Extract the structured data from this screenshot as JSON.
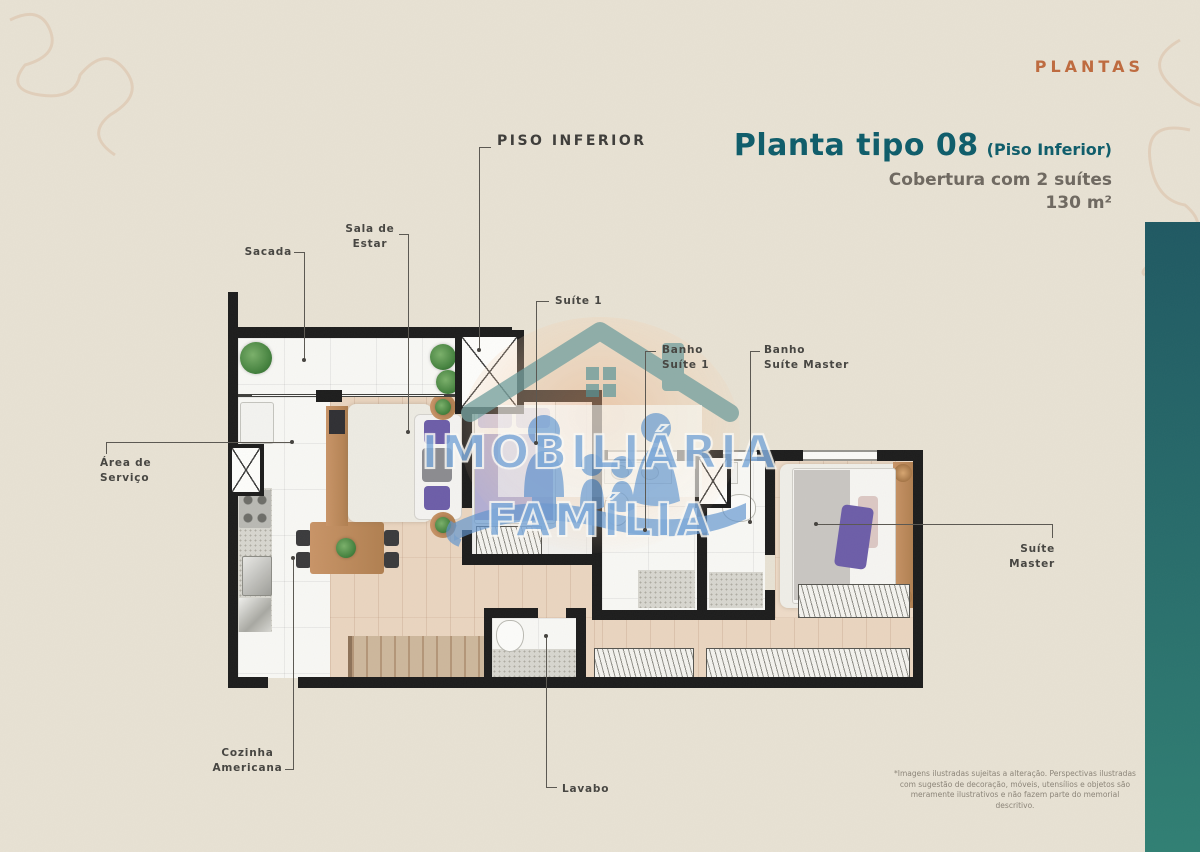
{
  "header": {
    "tag": "PLANTAS",
    "title": "Planta tipo 08",
    "title_note": "(Piso Inferior)",
    "subtitle": "Cobertura com 2 suítes",
    "area": "130 m²"
  },
  "plan": {
    "floor_label": "PISO  INFERIOR",
    "rooms": [
      {
        "label": "Sacada"
      },
      {
        "label": "Sala de\nEstar"
      },
      {
        "label": "Suíte 1"
      },
      {
        "label": "Banho\nSuíte 1"
      },
      {
        "label": "Banho\nSuíte Master"
      },
      {
        "label": "Área de\nServiço"
      },
      {
        "label": "Suíte\nMaster"
      },
      {
        "label": "Cozinha\nAmericana"
      },
      {
        "label": "Lavabo"
      }
    ]
  },
  "watermark": {
    "line1": "IMOBILIÁRIA",
    "line2": "FAMÍLIA"
  },
  "footer": {
    "disclaimer": "*Imagens ilustradas sujeitas a alteração. Perspectivas ilustradas com sugestão de decoração, móveis, utensílios e objetos são meramente ilustrativos e não fazem parte do memorial descritivo."
  },
  "colors": {
    "background_paper": "#e8e2d4",
    "accent_teal_title": "#0d5c6a",
    "accent_orange": "#bf6a3e",
    "sidebar_teal_top": "#1e5862",
    "sidebar_teal_bottom": "#2f7f73",
    "wall_black": "#1c1c1c",
    "watermark_blue": "#7fabdb"
  }
}
